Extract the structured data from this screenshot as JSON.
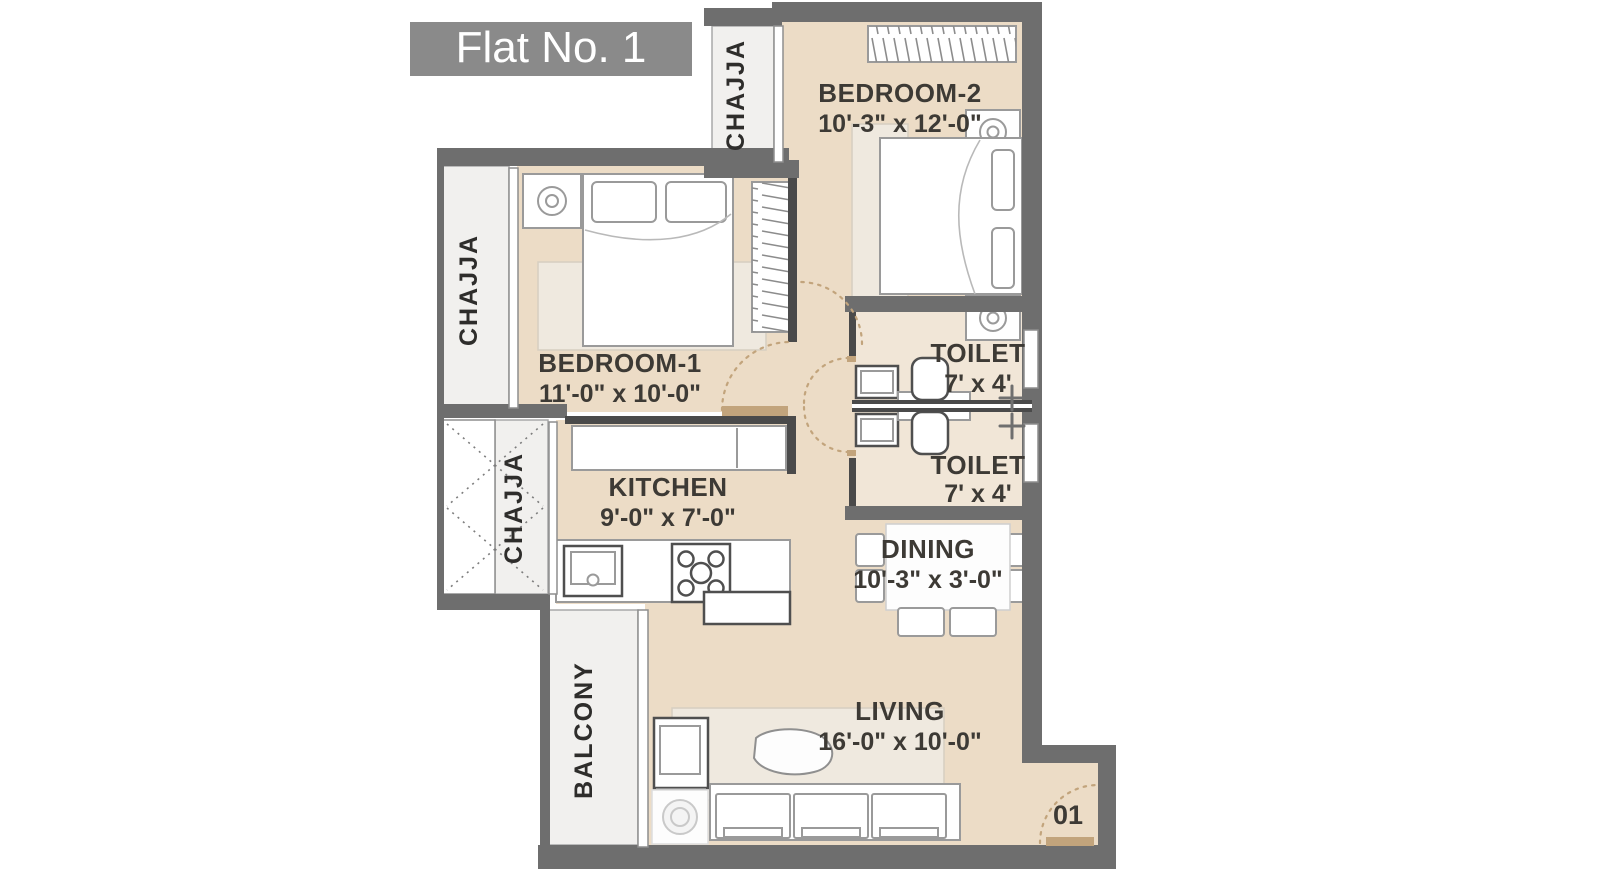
{
  "title": "Flat No. 1",
  "unit_label": "01",
  "rooms": {
    "bedroom2": {
      "name": "BEDROOM-2",
      "dims": "10'-3\" x 12'-0\""
    },
    "bedroom1": {
      "name": "BEDROOM-1",
      "dims": "11'-0\" x 10'-0\""
    },
    "toilet_top": {
      "name": "TOILET",
      "dims": "7' x 4'"
    },
    "toilet_bottom": {
      "name": "TOILET",
      "dims": "7' x 4'"
    },
    "kitchen": {
      "name": "KITCHEN",
      "dims": "9'-0\" x 7'-0\""
    },
    "dining": {
      "name": "DINING",
      "dims": "10'-3\" x 3'-0\""
    },
    "living": {
      "name": "LIVING",
      "dims": "16'-0\" x 10'-0\""
    },
    "balcony": {
      "name": "BALCONY"
    },
    "chajja": {
      "name": "CHAJJA"
    }
  },
  "colors": {
    "wall": "#6e6e6e",
    "pwall": "#4a4a4a",
    "floor": "#ecdcc6",
    "toilet_floor": "#f1e6d7",
    "light": "#f1f0ee",
    "wood": "#c2a47c",
    "label": "#3d3a35",
    "title_bg": "#8a8a8a",
    "title_text": "#ffffff"
  }
}
